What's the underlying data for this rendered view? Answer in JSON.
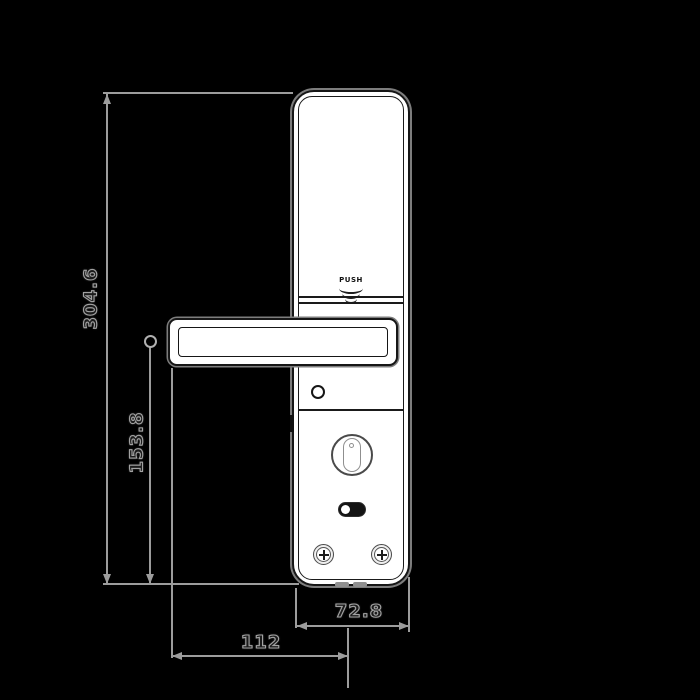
{
  "lock": {
    "push_label": "PUSH"
  },
  "dimensions": {
    "overall_height": "304.6",
    "handle_center_to_bottom": "153.8",
    "body_width": "72.8",
    "handle_tip_to_center": "112"
  },
  "icons": [
    "push-arcs-icon",
    "thumb-turn-knob",
    "screw-cross-icon"
  ],
  "colors": {
    "background": "#000000",
    "dimension_line": "#9c9c9c",
    "dimension_text_fill": "#1b1b1b",
    "dimension_text_outline": "#a2a2a2",
    "body_fill": "#ffffff",
    "body_outline": "#161616"
  }
}
